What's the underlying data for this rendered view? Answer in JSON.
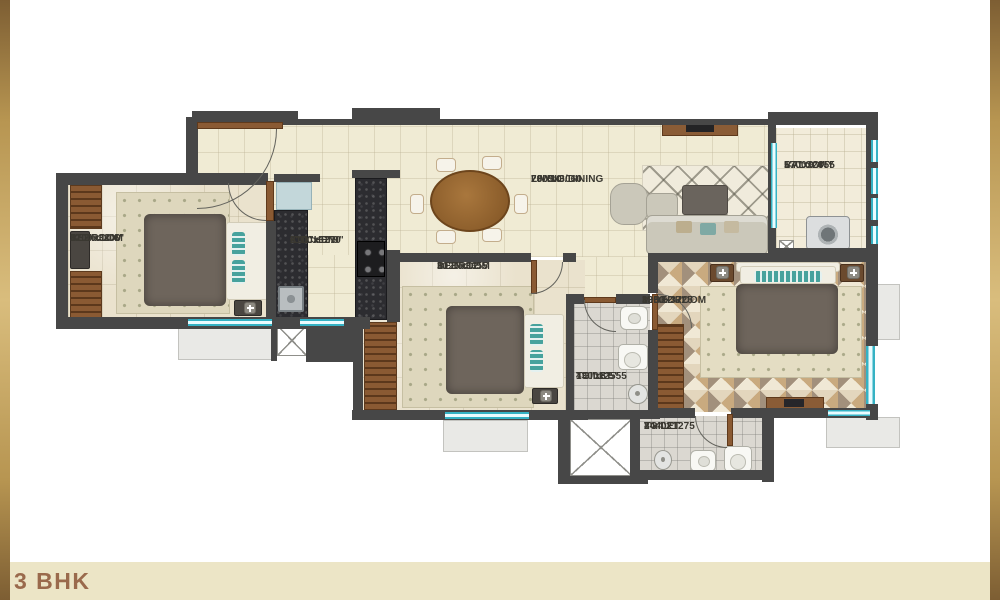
{
  "plan_title": "3 BHK",
  "rooms": [
    {
      "name": "BEDROOM",
      "size_mm": "3700x3200",
      "size_ft": "12'2\"x10'6\""
    },
    {
      "name": "KITCHEN",
      "size_mm": "2100x3270",
      "size_ft": "6'11\"x10'9\""
    },
    {
      "name": "LIVING/DINING",
      "size_mm": "7005x3060",
      "size_ft": "23'x10'"
    },
    {
      "name": "BALCONY",
      "size_mm": "1700x2855",
      "size_ft": "5'7\"x9'4\""
    },
    {
      "name": "BEDROOM",
      "size_mm": "3125x3655",
      "size_ft": "10'3\"x12'"
    },
    {
      "name": "M.BEDROOM",
      "size_mm": "3960x3725",
      "size_ft": "13'x12'3\""
    },
    {
      "name": "TOILET",
      "size_mm": "1300x2555",
      "size_ft": "4'3\"x8'5\""
    },
    {
      "name": "TOILET",
      "size_mm": "2440x1275",
      "size_ft": "8'x4'2\""
    }
  ],
  "icons": {
    "bedside_lamp": "+",
    "duct_shaft": "X"
  },
  "colors": {
    "wall": "#474747",
    "floor_cream": "#F0EBD4",
    "floor_tile": "#EAE2CD",
    "toilet_floor": "#DBD8D1",
    "window_accent": "#35B2C4",
    "wood": "#8A5A33",
    "pillow_teal": "#47A29D",
    "band_bg": "#ECE5C6",
    "title_text": "#9A6A4C",
    "frame_gold": "#B79551"
  }
}
